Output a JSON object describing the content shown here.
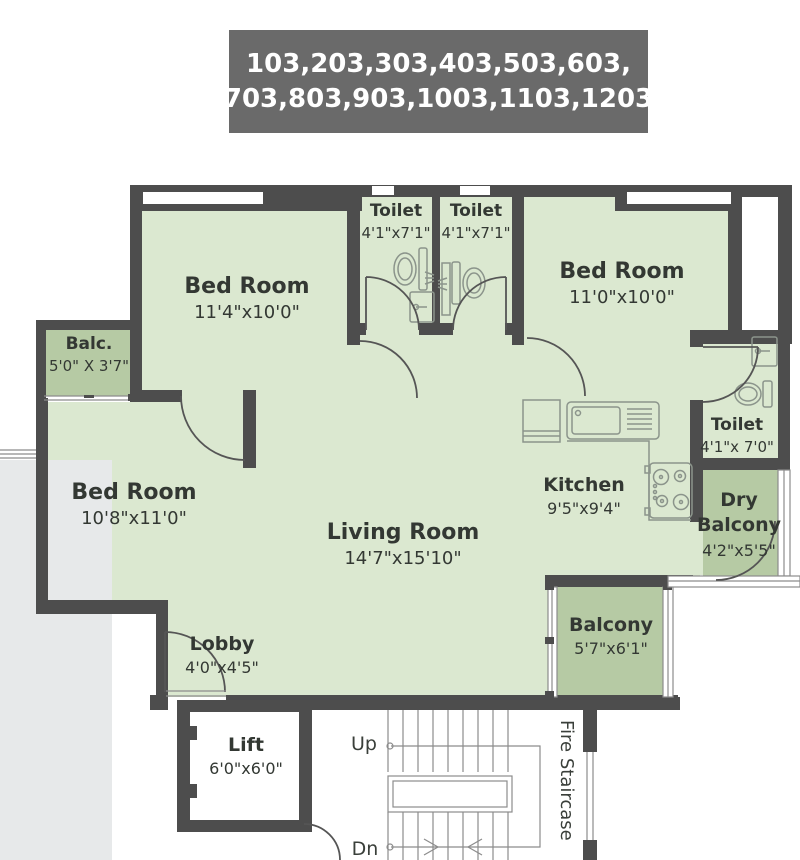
{
  "header": {
    "line1": "103,203,303,403,503,603,",
    "line2": "703,803,903,1003,1103,1203"
  },
  "rooms": {
    "bed_top_left": {
      "name": "Bed Room",
      "dim": "11'4\"x10'0\""
    },
    "toilet_a": {
      "name": "Toilet",
      "dim": "4'1\"x7'1\""
    },
    "toilet_b": {
      "name": "Toilet",
      "dim": "4'1\"x7'1\""
    },
    "bed_right": {
      "name": "Bed Room",
      "dim": "11'0\"x10'0\""
    },
    "balc_left": {
      "name": "Balc.",
      "dim": "5'0\" X 3'7\""
    },
    "bed_left": {
      "name": "Bed Room",
      "dim": "10'8\"x11'0\""
    },
    "living": {
      "name": "Living Room",
      "dim": "14'7\"x15'10\""
    },
    "kitchen": {
      "name": "Kitchen",
      "dim": "9'5\"x9'4\""
    },
    "toilet_right": {
      "name": "Toilet",
      "dim": "4'1\"x 7'0\""
    },
    "dry_balcony": {
      "name": "Dry Balcony",
      "dim": "4'2\"x5'5\""
    },
    "balcony": {
      "name": "Balcony",
      "dim": "5'7\"x6'1\""
    },
    "lobby": {
      "name": "Lobby",
      "dim": "4'0\"x4'5\""
    },
    "lift": {
      "name": "Lift",
      "dim": "6'0\"x6'0\""
    }
  },
  "stairs": {
    "up_label": "Up",
    "down_label": "Dn",
    "fire_label": "Fire Staircase"
  },
  "colors": {
    "wall": "#4d4d4d",
    "room_fill": "#dbe8d0",
    "balcony_fill": "#b6caa4",
    "header_bg": "#6a6a6a",
    "outside": "#e7e9ea",
    "text": "#333833",
    "line": "#8b948b",
    "stair": "#8c8c8c"
  }
}
